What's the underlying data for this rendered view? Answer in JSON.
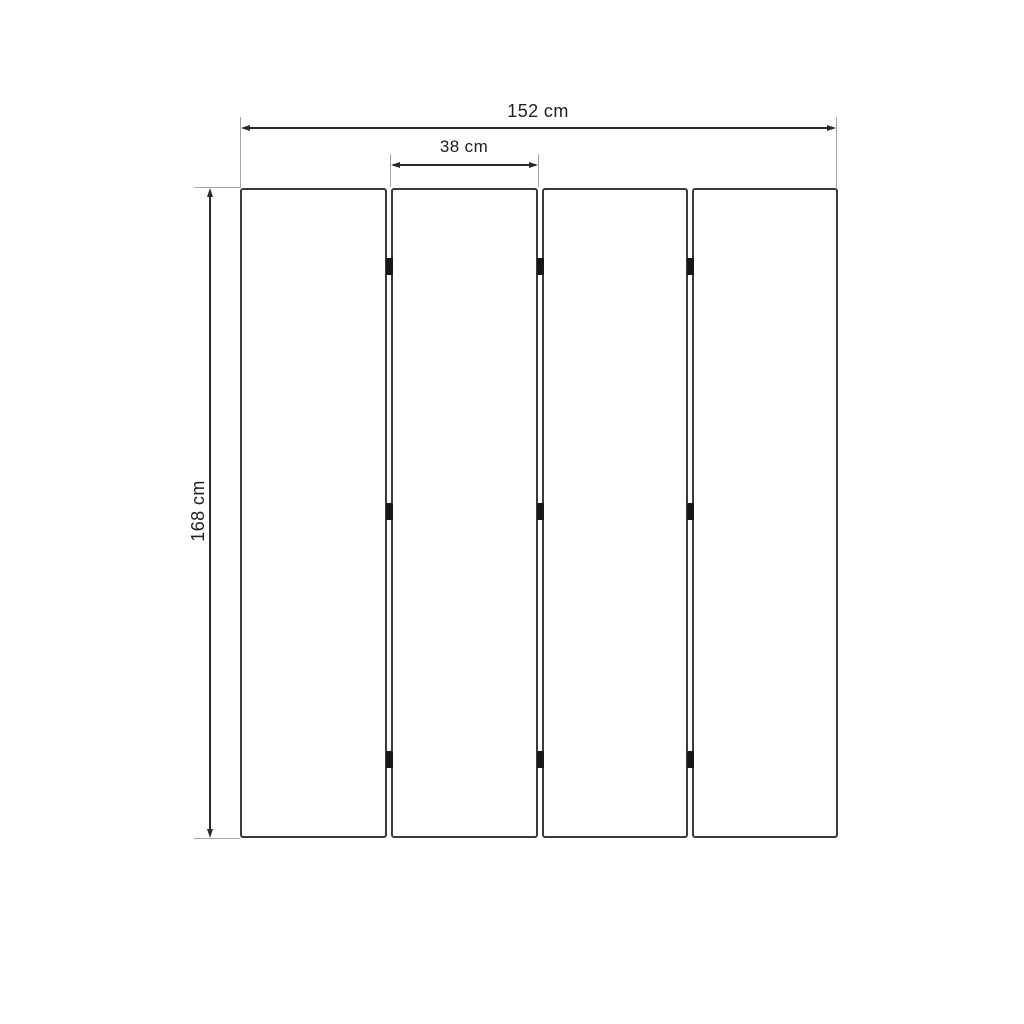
{
  "figure": {
    "type": "dimension-diagram",
    "panel_count": 4,
    "hinge_gaps": 3,
    "hinges_per_gap": 3,
    "units": "cm",
    "dimensions": {
      "total_width": {
        "label": "152 cm",
        "value_cm": 152
      },
      "panel_width": {
        "label": "38 cm",
        "value_cm": 38
      },
      "height": {
        "label": "168 cm",
        "value_cm": 168
      }
    },
    "colors": {
      "dimension_line": "#2b2b2b",
      "extension_line": "#a6a6a6",
      "panel_border": "#3a3a3a",
      "hinge": "#171717",
      "text": "#1e1e1e",
      "background": "#ffffff"
    }
  }
}
